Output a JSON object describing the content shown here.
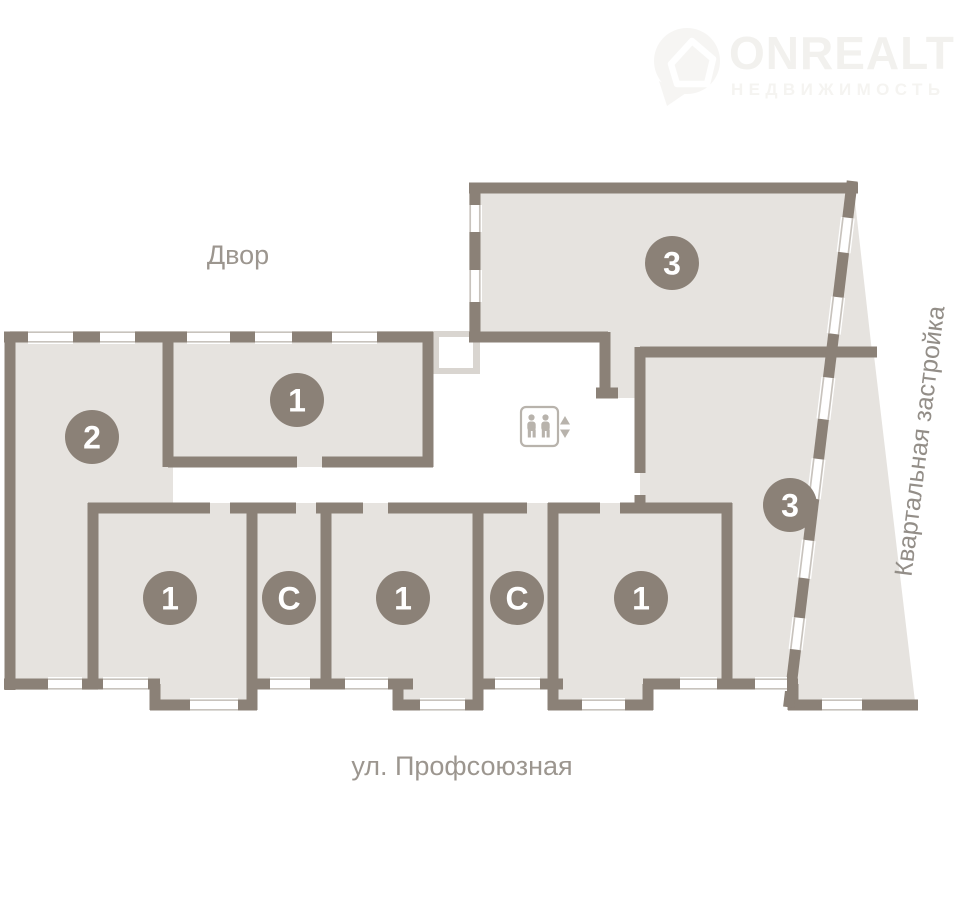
{
  "logo": {
    "brand": "ONREALT",
    "subtitle": "НЕДВИЖИМОСТЬ"
  },
  "map_labels": {
    "courtyard": "Двор",
    "street": "ул. Профсоюзная",
    "quarter": "Квартальная застройка"
  },
  "units": [
    {
      "id": "apt-2",
      "label": "2"
    },
    {
      "id": "apt-1-top",
      "label": "1"
    },
    {
      "id": "apt-3-top",
      "label": "3"
    },
    {
      "id": "apt-3-right",
      "label": "3"
    },
    {
      "id": "apt-1-bottom-1",
      "label": "1"
    },
    {
      "id": "apt-s-bottom-1",
      "label": "С"
    },
    {
      "id": "apt-1-bottom-2",
      "label": "1"
    },
    {
      "id": "apt-s-bottom-2",
      "label": "С"
    },
    {
      "id": "apt-1-bottom-3",
      "label": "1"
    }
  ],
  "colors": {
    "wall": "#8b8177",
    "room_fill": "#e6e3df",
    "window_line": "#c8c3bd",
    "badge": "#8b8177",
    "badge_text": "#ffffff",
    "label_text": "#9c968f",
    "elevator_icon": "#b8b3ac",
    "background": "#ffffff"
  }
}
